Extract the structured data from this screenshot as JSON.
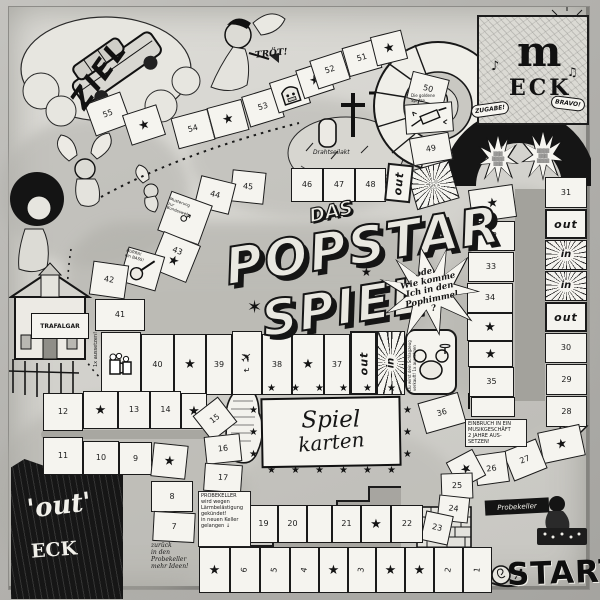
{
  "title": {
    "das": "DAS",
    "line1": "POPSTAR",
    "line2": "SPIEL",
    "burst": "oder\nWie komme\nIch in den\nPophimmel\n?"
  },
  "labels": {
    "ziel": "ZIEL",
    "start": "START",
    "troet": "TRÖT!",
    "drahtseilakt": "Drahtseilakt",
    "cards_line1": "Spiel",
    "cards_line2": "karten",
    "m_eck_letter": "m",
    "m_eck_word": "ECK",
    "zugabe": "ZUGABE!",
    "bravo": "BRAVO!",
    "out_corner_word1": "'out'",
    "out_corner_word2": "ECK",
    "probekeller_banner": "Probekeller",
    "building_sign": "TRAFALGAR",
    "building_penalty": "1x aussetzen!",
    "in_label": "in",
    "out_label": "out"
  },
  "notes": {
    "einbruch": "EINBRUCH IN EIN\nMUSIKGESCHÄFT\n2 JAHRE AUS-\nSETZEN!",
    "probekeller_gekuendigt": "PROBEKELLER\nwird wegen\nLärmbelästigung\ngekündet!\nin neuen Keller\ngelangen ↓",
    "zurueck": "zurück\nin den\nProbekeller\nmehr Ideen!",
    "schlagzeug": "Du wirst dein Schlagzeug verkauft! 1x aussetzen",
    "musterung": "Musterung\nzur\nBundeswehr",
    "bass": "HURRA!\nein BASS!",
    "spritze": "Die goldene\nSpritze"
  },
  "squares": [
    {
      "t": "55",
      "k": "p",
      "x": 80,
      "y": 90,
      "w": 38,
      "h": 34,
      "r": -20
    },
    {
      "k": "s",
      "x": 117,
      "y": 102,
      "w": 36,
      "h": 32,
      "r": -18
    },
    {
      "t": "54",
      "k": "p",
      "x": 165,
      "y": 106,
      "w": 38,
      "h": 32,
      "r": -15
    },
    {
      "k": "s",
      "x": 201,
      "y": 96,
      "w": 36,
      "h": 32,
      "r": -15
    },
    {
      "t": "53",
      "k": "p",
      "x": 236,
      "y": 84,
      "w": 36,
      "h": 32,
      "r": -17
    },
    {
      "k": "juke",
      "x": 264,
      "y": 70,
      "w": 34,
      "h": 32,
      "r": -18
    },
    {
      "k": "s",
      "x": 290,
      "y": 58,
      "w": 32,
      "h": 30,
      "r": -18
    },
    {
      "t": "52",
      "k": "p",
      "x": 304,
      "y": 48,
      "w": 34,
      "h": 30,
      "r": -18
    },
    {
      "t": "51",
      "k": "p",
      "x": 336,
      "y": 36,
      "w": 34,
      "h": 30,
      "r": -16
    },
    {
      "k": "s",
      "x": 364,
      "y": 26,
      "w": 32,
      "h": 30,
      "r": -14
    },
    {
      "t": "50",
      "k": "p",
      "x": 400,
      "y": 68,
      "w": 38,
      "h": 28,
      "r": 14
    },
    {
      "k": "syr",
      "x": 396,
      "y": 96,
      "w": 48,
      "h": 30,
      "r": -4
    },
    {
      "t": "49",
      "k": "p",
      "x": 402,
      "y": 128,
      "w": 40,
      "h": 28,
      "r": -10
    },
    {
      "k": "u",
      "x": 402,
      "y": 158,
      "w": 44,
      "h": 40,
      "r": -16
    },
    {
      "t": "45",
      "k": "p",
      "x": 222,
      "y": 164,
      "w": 34,
      "h": 32,
      "r": 6
    },
    {
      "t": "46",
      "k": "p",
      "x": 282,
      "y": 161,
      "w": 32,
      "h": 34,
      "r": 0
    },
    {
      "t": "47",
      "k": "p",
      "x": 314,
      "y": 161,
      "w": 32,
      "h": 34,
      "r": 0
    },
    {
      "t": "48",
      "k": "p",
      "x": 346,
      "y": 161,
      "w": 31,
      "h": 34,
      "r": 0
    },
    {
      "t": "out",
      "k": "o",
      "x": 377,
      "y": 157,
      "w": 26,
      "h": 38,
      "r": 6,
      "tr": -90
    },
    {
      "t": "44",
      "k": "p",
      "x": 188,
      "y": 172,
      "w": 36,
      "h": 32,
      "r": 14
    },
    {
      "k": "mars",
      "x": 154,
      "y": 190,
      "w": 44,
      "h": 42,
      "r": 20
    },
    {
      "t": "43",
      "k": "ns",
      "x": 146,
      "y": 230,
      "w": 40,
      "h": 40,
      "r": 22
    },
    {
      "k": "bass",
      "x": 114,
      "y": 244,
      "w": 38,
      "h": 36,
      "r": 16
    },
    {
      "t": "42",
      "k": "p",
      "x": 82,
      "y": 256,
      "w": 36,
      "h": 34,
      "r": 8
    },
    {
      "t": "41",
      "k": "p",
      "x": 86,
      "y": 292,
      "w": 50,
      "h": 32,
      "r": 0
    },
    {
      "k": "beer",
      "x": 92,
      "y": 325,
      "w": 40,
      "h": 63,
      "r": 0
    },
    {
      "t": "40",
      "k": "p",
      "x": 132,
      "y": 327,
      "w": 33,
      "h": 61,
      "r": 0
    },
    {
      "k": "s",
      "x": 165,
      "y": 327,
      "w": 32,
      "h": 61,
      "r": 0
    },
    {
      "t": "39",
      "k": "p",
      "x": 197,
      "y": 327,
      "w": 26,
      "h": 61,
      "r": 0
    },
    {
      "k": "plane",
      "x": 223,
      "y": 324,
      "w": 30,
      "h": 64,
      "r": 0
    },
    {
      "t": "38",
      "k": "p",
      "x": 253,
      "y": 327,
      "w": 30,
      "h": 61,
      "r": 0
    },
    {
      "k": "s",
      "x": 283,
      "y": 327,
      "w": 32,
      "h": 61,
      "r": 0
    },
    {
      "t": "37",
      "k": "p",
      "x": 315,
      "y": 327,
      "w": 26,
      "h": 61,
      "r": 0
    },
    {
      "t": "out",
      "k": "o",
      "x": 341,
      "y": 324,
      "w": 27,
      "h": 64,
      "r": 0,
      "tr": -90
    },
    {
      "t": "in",
      "k": "i",
      "x": 368,
      "y": 324,
      "w": 28,
      "h": 64,
      "r": 0,
      "tr": -90
    },
    {
      "k": "drum",
      "x": 396,
      "y": 322,
      "w": 52,
      "h": 66,
      "r": 0
    },
    {
      "t": "36",
      "k": "p",
      "x": 412,
      "y": 390,
      "w": 42,
      "h": 32,
      "r": -16
    },
    {
      "k": "s",
      "x": 461,
      "y": 180,
      "w": 45,
      "h": 33,
      "r": -8
    },
    {
      "t": "32",
      "k": "p",
      "x": 460,
      "y": 214,
      "w": 46,
      "h": 30,
      "r": 0
    },
    {
      "t": "33",
      "k": "p",
      "x": 459,
      "y": 245,
      "w": 46,
      "h": 30,
      "r": 0
    },
    {
      "t": "34",
      "k": "p",
      "x": 458,
      "y": 276,
      "w": 46,
      "h": 30,
      "r": 0
    },
    {
      "k": "s",
      "x": 458,
      "y": 306,
      "w": 46,
      "h": 28,
      "r": 0
    },
    {
      "k": "s",
      "x": 459,
      "y": 334,
      "w": 45,
      "h": 26,
      "r": 0
    },
    {
      "t": "35",
      "k": "p",
      "x": 460,
      "y": 360,
      "w": 45,
      "h": 30,
      "r": 0
    },
    {
      "k": "jail",
      "x": 462,
      "y": 390,
      "w": 44,
      "h": 20,
      "r": 0
    },
    {
      "t": "31",
      "k": "p",
      "x": 536,
      "y": 170,
      "w": 42,
      "h": 31,
      "r": 0
    },
    {
      "t": "out",
      "k": "o",
      "x": 536,
      "y": 202,
      "w": 42,
      "h": 30,
      "r": 0,
      "tr": 0
    },
    {
      "t": "in",
      "k": "i",
      "x": 536,
      "y": 233,
      "w": 42,
      "h": 30,
      "r": 0,
      "tr": 0
    },
    {
      "t": "in",
      "k": "i",
      "x": 536,
      "y": 264,
      "w": 42,
      "h": 30,
      "r": 0,
      "tr": 0
    },
    {
      "t": "out",
      "k": "o",
      "x": 536,
      "y": 295,
      "w": 42,
      "h": 30,
      "r": 0,
      "tr": 0
    },
    {
      "t": "30",
      "k": "p",
      "x": 536,
      "y": 326,
      "w": 42,
      "h": 30,
      "r": 0
    },
    {
      "t": "29",
      "k": "p",
      "x": 537,
      "y": 357,
      "w": 41,
      "h": 31,
      "r": 0
    },
    {
      "t": "28",
      "k": "p",
      "x": 537,
      "y": 389,
      "w": 41,
      "h": 31,
      "r": 0
    },
    {
      "k": "s",
      "x": 531,
      "y": 421,
      "w": 43,
      "h": 32,
      "r": -12
    },
    {
      "t": "27",
      "k": "p",
      "x": 498,
      "y": 437,
      "w": 36,
      "h": 32,
      "r": -22
    },
    {
      "t": "26",
      "k": "p",
      "x": 466,
      "y": 446,
      "w": 33,
      "h": 31,
      "r": -8
    },
    {
      "k": "s",
      "x": 442,
      "y": 447,
      "w": 30,
      "h": 30,
      "r": -28
    },
    {
      "t": "25",
      "k": "p",
      "x": 432,
      "y": 466,
      "w": 32,
      "h": 26,
      "r": -2
    },
    {
      "t": "24",
      "k": "p",
      "x": 429,
      "y": 489,
      "w": 31,
      "h": 26,
      "r": 6
    },
    {
      "t": "23",
      "k": "p",
      "x": 414,
      "y": 506,
      "w": 28,
      "h": 30,
      "r": 12
    },
    {
      "t": "18",
      "k": "p",
      "x": 211,
      "y": 498,
      "w": 29,
      "h": 38,
      "r": 0
    },
    {
      "t": "19",
      "k": "p",
      "x": 240,
      "y": 498,
      "w": 29,
      "h": 38,
      "r": 0
    },
    {
      "t": "20",
      "k": "p",
      "x": 269,
      "y": 498,
      "w": 29,
      "h": 38,
      "r": 0
    },
    {
      "k": "b",
      "x": 298,
      "y": 498,
      "w": 25,
      "h": 38,
      "r": 0
    },
    {
      "t": "21",
      "k": "p",
      "x": 323,
      "y": 498,
      "w": 29,
      "h": 38,
      "r": 0
    },
    {
      "k": "s",
      "x": 352,
      "y": 498,
      "w": 30,
      "h": 38,
      "r": 0
    },
    {
      "t": "22",
      "k": "p",
      "x": 382,
      "y": 498,
      "w": 32,
      "h": 38,
      "r": 0
    },
    {
      "k": "s",
      "x": 190,
      "y": 540,
      "w": 31,
      "h": 46,
      "r": 0
    },
    {
      "t": "6",
      "k": "p",
      "x": 221,
      "y": 540,
      "w": 30,
      "h": 46,
      "r": 0,
      "tr": -80
    },
    {
      "t": "5",
      "k": "p",
      "x": 251,
      "y": 540,
      "w": 30,
      "h": 46,
      "r": 0,
      "tr": -80
    },
    {
      "t": "4",
      "k": "p",
      "x": 281,
      "y": 540,
      "w": 29,
      "h": 46,
      "r": 0,
      "tr": -80
    },
    {
      "k": "s",
      "x": 310,
      "y": 540,
      "w": 29,
      "h": 46,
      "r": 0
    },
    {
      "t": "3",
      "k": "p",
      "x": 339,
      "y": 540,
      "w": 28,
      "h": 46,
      "r": 0,
      "tr": -80
    },
    {
      "k": "s",
      "x": 367,
      "y": 540,
      "w": 29,
      "h": 46,
      "r": 0
    },
    {
      "k": "s",
      "x": 396,
      "y": 540,
      "w": 29,
      "h": 46,
      "r": 0
    },
    {
      "t": "2",
      "k": "p",
      "x": 425,
      "y": 540,
      "w": 29,
      "h": 46,
      "r": 0,
      "tr": -80
    },
    {
      "t": "1",
      "k": "p",
      "x": 454,
      "y": 540,
      "w": 29,
      "h": 46,
      "r": 0,
      "tr": -80
    },
    {
      "t": "8",
      "k": "p",
      "x": 142,
      "y": 474,
      "w": 42,
      "h": 31,
      "r": 0
    },
    {
      "t": "7",
      "k": "p",
      "x": 144,
      "y": 505,
      "w": 42,
      "h": 30,
      "r": 3
    },
    {
      "t": "12",
      "k": "p",
      "x": 34,
      "y": 386,
      "w": 40,
      "h": 38,
      "r": 0
    },
    {
      "k": "s",
      "x": 74,
      "y": 384,
      "w": 35,
      "h": 38,
      "r": 0
    },
    {
      "t": "13",
      "k": "p",
      "x": 109,
      "y": 384,
      "w": 32,
      "h": 38,
      "r": 0
    },
    {
      "t": "14",
      "k": "p",
      "x": 141,
      "y": 384,
      "w": 31,
      "h": 38,
      "r": 0
    },
    {
      "k": "s",
      "x": 172,
      "y": 386,
      "w": 26,
      "h": 36,
      "r": 0
    },
    {
      "t": "15",
      "k": "p",
      "x": 190,
      "y": 396,
      "w": 32,
      "h": 32,
      "r": -38
    },
    {
      "t": "16",
      "k": "p",
      "x": 196,
      "y": 428,
      "w": 36,
      "h": 28,
      "r": -6
    },
    {
      "t": "17",
      "k": "p",
      "x": 195,
      "y": 457,
      "w": 38,
      "h": 28,
      "r": 4
    },
    {
      "t": "11",
      "k": "p",
      "x": 34,
      "y": 430,
      "w": 40,
      "h": 38,
      "r": 0
    },
    {
      "t": "10",
      "k": "p",
      "x": 74,
      "y": 434,
      "w": 36,
      "h": 34,
      "r": 0
    },
    {
      "t": "9",
      "k": "p",
      "x": 110,
      "y": 435,
      "w": 33,
      "h": 33,
      "r": 0
    },
    {
      "k": "s",
      "x": 143,
      "y": 437,
      "w": 35,
      "h": 34,
      "r": 6
    }
  ]
}
